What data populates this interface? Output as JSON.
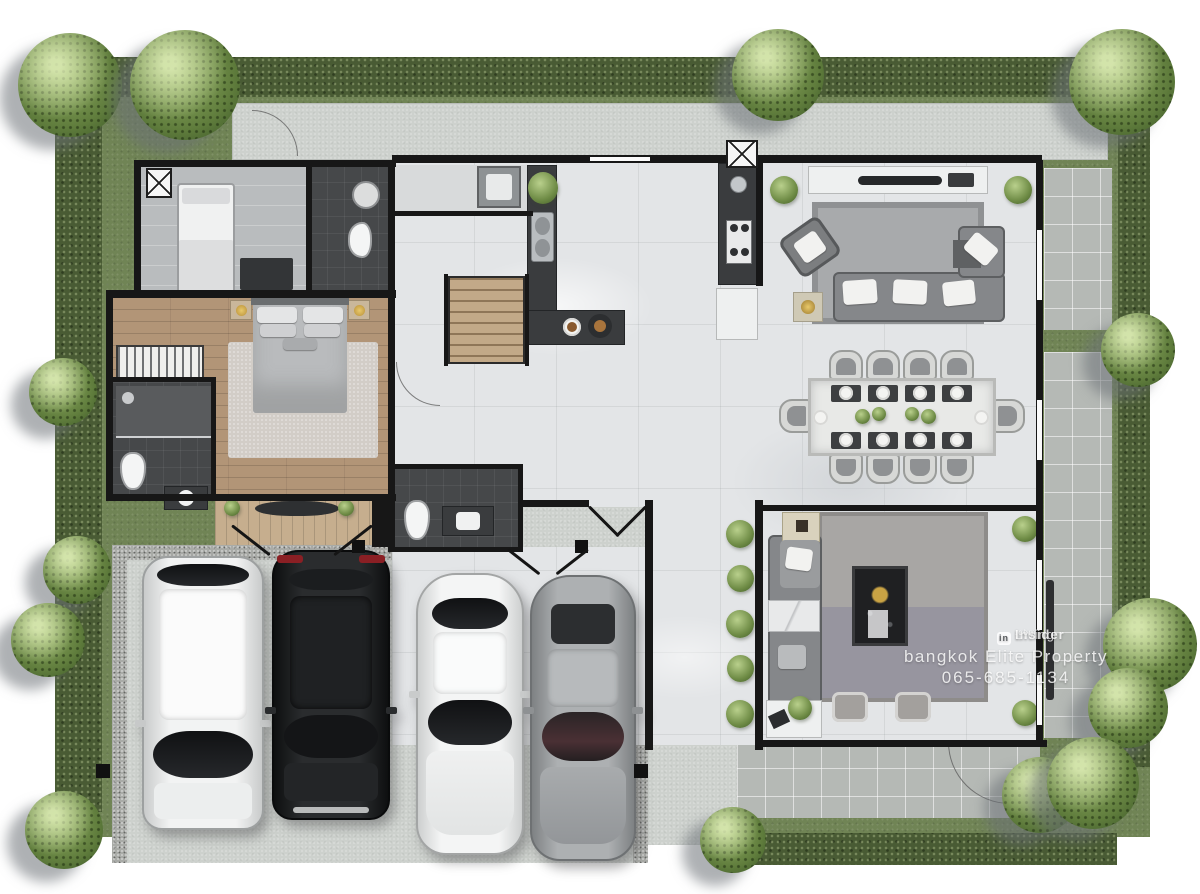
{
  "watermark": {
    "logo_badge": "in",
    "brand": "Living",
    "brand_bold": "Insider",
    "brand_suffix": ".com",
    "line2": "bangkok Elite Property",
    "phone": "065-685-1134"
  },
  "palette": {
    "background": "#ffffff",
    "hedge_green": "#495b34",
    "grass_green": "#708455",
    "tree_green": "#5f7c3c",
    "walkway_concrete": "#cdd1cd",
    "patio_tile": "#b5b9b5",
    "marble_floor": "#e3e5e7",
    "wood_floor": "#b29577",
    "deck_wood": "#c6ae8e",
    "bath_floor_dark": "#46484a",
    "wall_black": "#171717",
    "counter_dark": "#3a3c3e",
    "sofa_gray": "#85878a",
    "watermark_text": "#ffffff"
  },
  "vehicles": [
    {
      "name": "white-suv",
      "body_color": "#ebecec"
    },
    {
      "name": "black-suv",
      "body_color": "#212325"
    },
    {
      "name": "white-sedan",
      "body_color": "#f0f1f1"
    },
    {
      "name": "silver-sedan",
      "body_color": "#a4a7a9"
    }
  ]
}
